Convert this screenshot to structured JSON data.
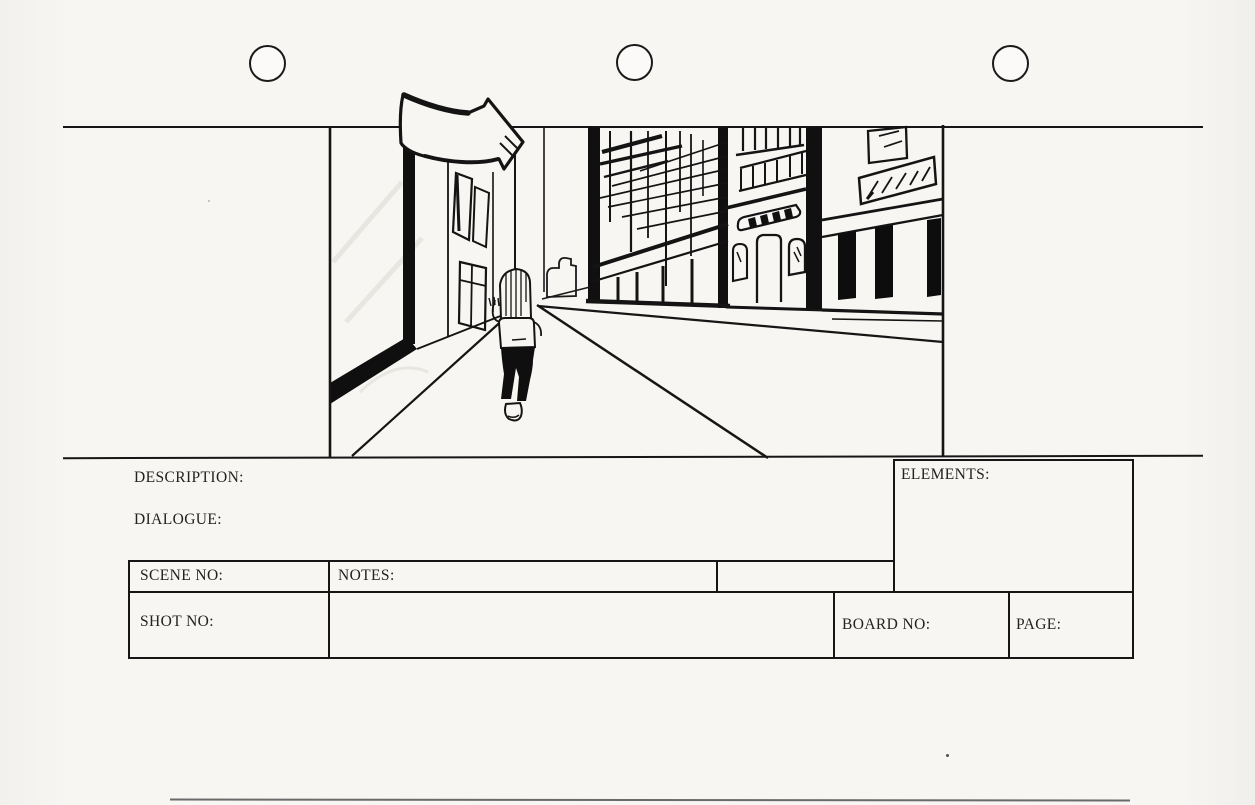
{
  "document": {
    "kind": "scanned storyboard template sheet",
    "ink_color": "#161616",
    "paper_color": "#f6f5f2"
  },
  "frame": {
    "sketch_subject": "person walking away down a one-point-perspective city street between buildings",
    "annotation_icon": "curved-arrow-right"
  },
  "fields": {
    "description": {
      "label": "DESCRIPTION:",
      "value": ""
    },
    "dialogue": {
      "label": "DIALOGUE:",
      "value": ""
    },
    "elements": {
      "label": "ELEMENTS:",
      "value": ""
    },
    "scene_no": {
      "label": "SCENE NO:",
      "value": ""
    },
    "notes": {
      "label": "NOTES:",
      "value": ""
    },
    "shot_no": {
      "label": "SHOT NO:",
      "value": ""
    },
    "board_no": {
      "label": "BOARD NO:",
      "value": ""
    },
    "page": {
      "label": "PAGE:",
      "value": ""
    }
  }
}
